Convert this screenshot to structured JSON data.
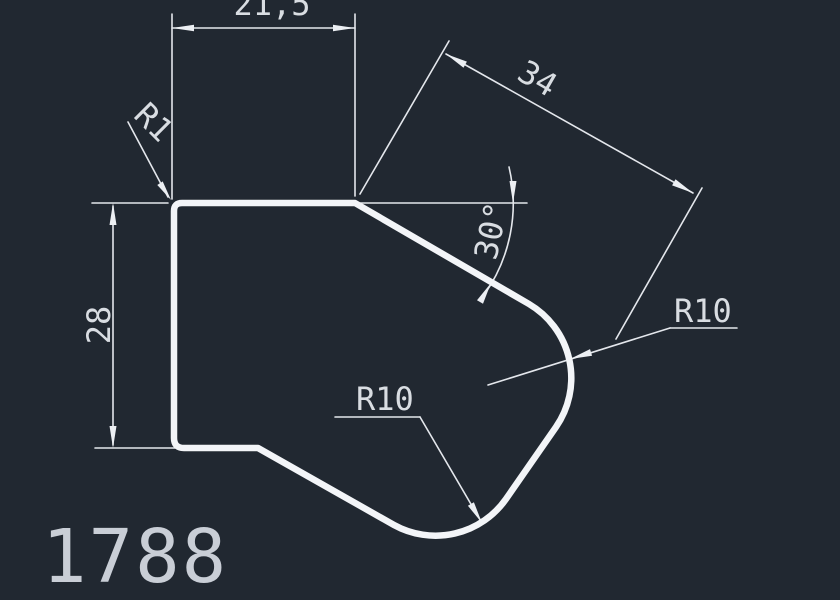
{
  "canvas": {
    "width": 840,
    "height": 600,
    "background": "#212831",
    "outline_color": "#f3f5f8",
    "dimension_color": "#e4e7ec",
    "text_color": "#d9dde2"
  },
  "drawing_number": "1788",
  "dimensions": {
    "top_width": {
      "label": "21,5"
    },
    "left_height": {
      "label": "28"
    },
    "diagonal_length": {
      "label": "34"
    },
    "angle": {
      "label": "30°"
    },
    "fillet_top_left": {
      "label": "R1"
    },
    "fillet_bottom": {
      "label": "R10"
    },
    "fillet_right": {
      "label": "R10"
    }
  }
}
